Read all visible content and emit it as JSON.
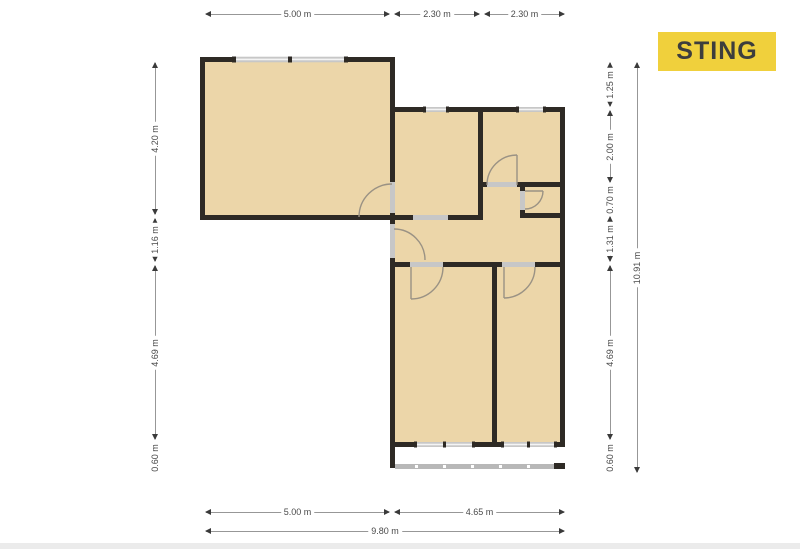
{
  "logo": {
    "label": "STING"
  },
  "colors": {
    "floor": "#ecd6a9",
    "wall": "#2e2a25",
    "opening": "#c7c7c7",
    "winline": "#f4f4f4",
    "arc": "#9a9284",
    "rail": "#b8b8b8",
    "dimline": "#979797",
    "dimarrow": "#3a3a3a",
    "dimtext": "#4a4a4a",
    "logobg": "#f0d03c",
    "logofg": "#3d3d3d"
  },
  "dimensions": {
    "horizontal": [
      {
        "label": "5.00 m",
        "x1": 205,
        "x2": 390,
        "y": 14
      },
      {
        "label": "2.30 m",
        "x1": 394,
        "x2": 480,
        "y": 14
      },
      {
        "label": "2.30 m",
        "x1": 484,
        "x2": 565,
        "y": 14
      },
      {
        "label": "5.00 m",
        "x1": 205,
        "x2": 390,
        "y": 512
      },
      {
        "label": "4.65 m",
        "x1": 394,
        "x2": 565,
        "y": 512
      },
      {
        "label": "9.80 m",
        "x1": 205,
        "x2": 565,
        "y": 531
      }
    ],
    "vertical": [
      {
        "label": "4.20 m",
        "y1": 62,
        "y2": 215,
        "x": 155
      },
      {
        "label": "1.16 m",
        "y1": 218,
        "y2": 262,
        "x": 155
      },
      {
        "label": "4.69 m",
        "y1": 265,
        "y2": 440,
        "x": 155
      },
      {
        "label": "0.60 m",
        "y1": 443,
        "y2": 473,
        "x": 155
      },
      {
        "label": "1.25 m",
        "y1": 62,
        "y2": 107,
        "x": 610
      },
      {
        "label": "2.00 m",
        "y1": 110,
        "y2": 183,
        "x": 610
      },
      {
        "label": "0.70 m",
        "y1": 186,
        "y2": 213,
        "x": 610
      },
      {
        "label": "1.31 m",
        "y1": 216,
        "y2": 262,
        "x": 610
      },
      {
        "label": "4.69 m",
        "y1": 265,
        "y2": 440,
        "x": 610
      },
      {
        "label": "0.60 m",
        "y1": 443,
        "y2": 473,
        "x": 610
      },
      {
        "label": "10.91 m",
        "y1": 62,
        "y2": 473,
        "x": 637
      }
    ]
  }
}
